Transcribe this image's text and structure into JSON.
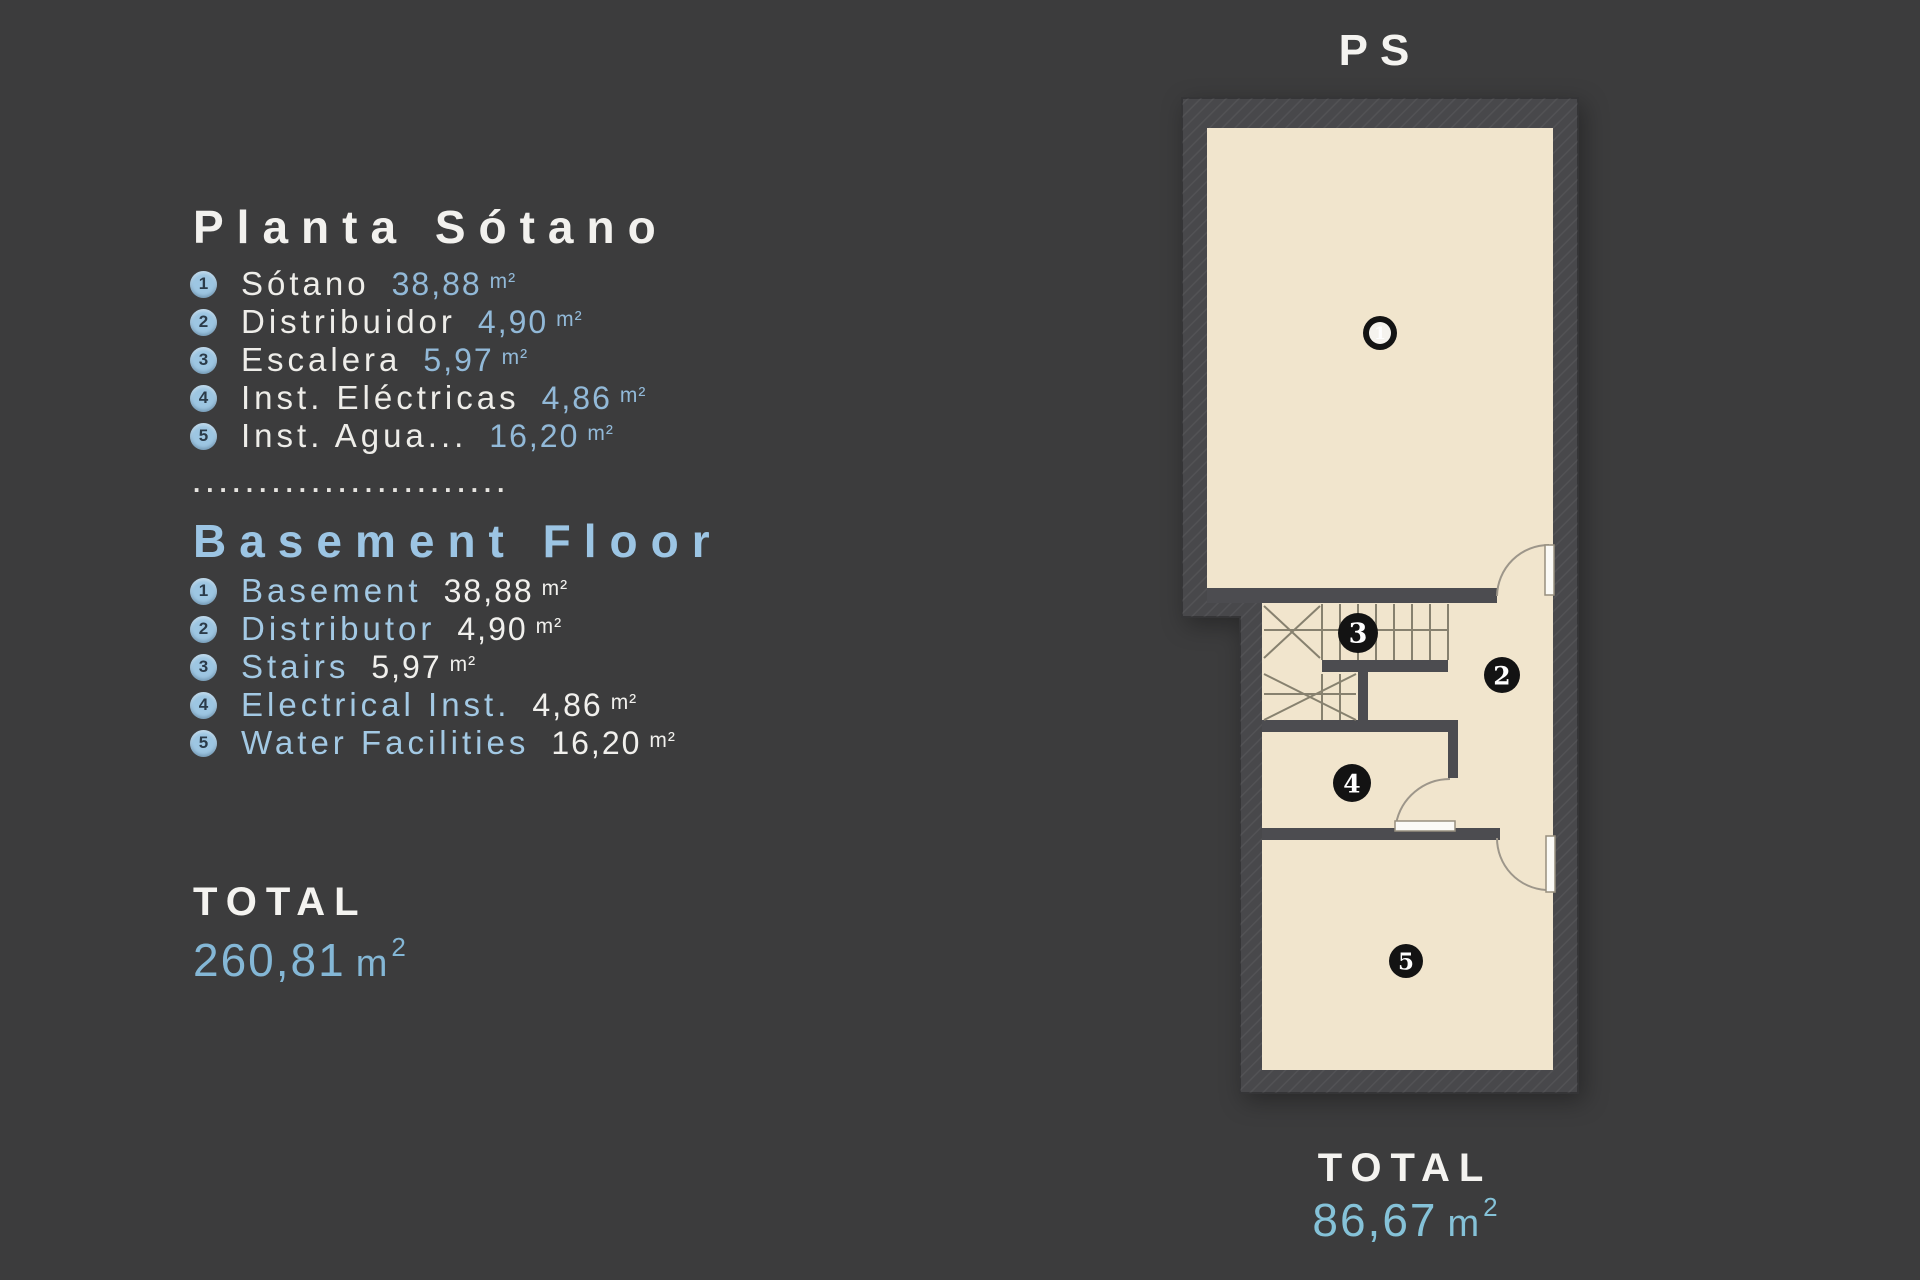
{
  "legend": {
    "title_es": "Planta Sótano",
    "items_es": [
      {
        "num": "1",
        "label": "Sótano",
        "value": "38,88",
        "unit": "m²"
      },
      {
        "num": "2",
        "label": "Distribuidor",
        "value": "4,90",
        "unit": "m²"
      },
      {
        "num": "3",
        "label": "Escalera",
        "value": "5,97",
        "unit": "m²"
      },
      {
        "num": "4",
        "label": "Inst. Eléctricas",
        "value": "4,86",
        "unit": "m²"
      },
      {
        "num": "5",
        "label": "Inst. Agua...",
        "value": "16,20",
        "unit": "m²"
      }
    ],
    "separator": "........................",
    "title_en": "Basement Floor",
    "items_en": [
      {
        "num": "1",
        "label": "Basement",
        "value": "38,88",
        "unit": "m²"
      },
      {
        "num": "2",
        "label": "Distributor",
        "value": "4,90",
        "unit": "m²"
      },
      {
        "num": "3",
        "label": "Stairs",
        "value": "5,97",
        "unit": "m²"
      },
      {
        "num": "4",
        "label": "Electrical Inst.",
        "value": "4,86",
        "unit": "m²"
      },
      {
        "num": "5",
        "label": "Water Facilities",
        "value": "16,20",
        "unit": "m²"
      }
    ],
    "total_label": "TOTAL",
    "total_value": "260,81",
    "total_unit": "m",
    "total_sup": "2"
  },
  "plan": {
    "title": "PS",
    "rooms": [
      {
        "num": "1"
      },
      {
        "num": "2"
      },
      {
        "num": "3"
      },
      {
        "num": "4"
      },
      {
        "num": "5"
      }
    ],
    "total_label": "TOTAL",
    "total_value": "86,67",
    "total_unit": "m",
    "total_sup": "2"
  },
  "colors": {
    "background": "#3c3c3d",
    "wall": "#48484b",
    "interior_wall": "#4c4c50",
    "floor": "#f1e5cd",
    "accent_blue_labels": "#a3c9e4",
    "accent_blue_values": "#92b9d8",
    "total_blue_left": "#84b7d6",
    "total_blue_plan": "#85c2d8",
    "badge_legend_bg": "#9dc6e2",
    "badge_plan_bg": "#131313",
    "text_white": "#f2f1ee"
  }
}
